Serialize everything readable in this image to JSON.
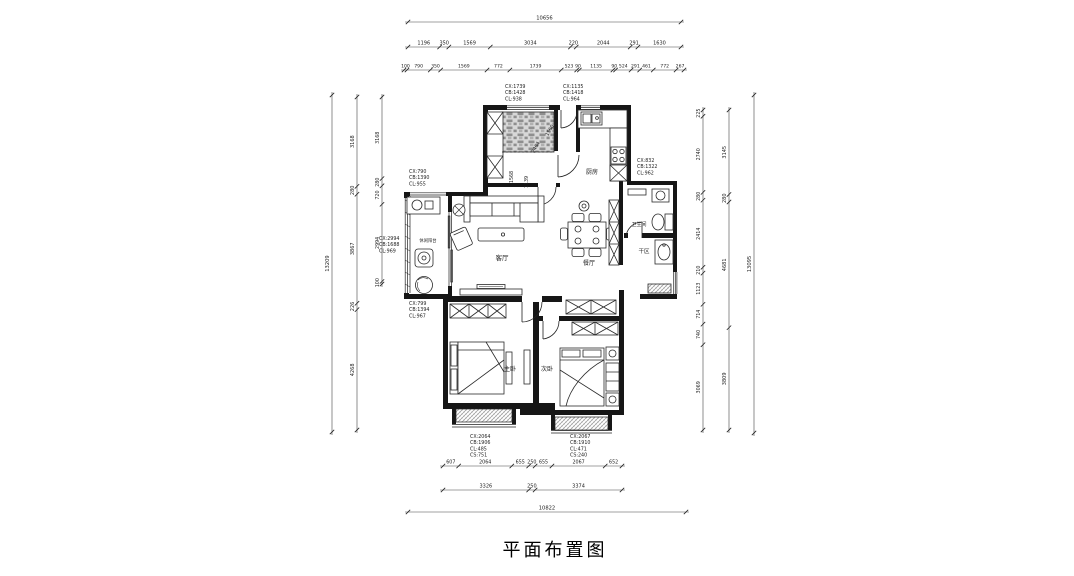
{
  "title": "平面布置图",
  "rooms": {
    "living": "客厅",
    "dining": "餐厅",
    "kitchen": "厨房",
    "bathroom": "卫生间",
    "dry_area": "干区",
    "master_bedroom": "主卧",
    "second_bedroom": "次卧",
    "balcony": "休闲阳台"
  },
  "dimensions": {
    "top": {
      "total": [
        "10656"
      ],
      "row2": [
        "1196",
        "350",
        "1569",
        "3034",
        "220",
        "2044",
        "291",
        "1630"
      ],
      "row3": [
        "100",
        "790",
        "350",
        "1569",
        "772",
        "1739",
        "523",
        "90",
        "1135",
        "90",
        "524",
        "291",
        "461",
        "772",
        "267"
      ]
    },
    "bottom": {
      "row1": [
        "607",
        "2064",
        "655",
        "250",
        "655",
        "2067",
        "652"
      ],
      "row2": [
        "3326",
        "250",
        "3374"
      ],
      "total": [
        "10822"
      ]
    },
    "left": {
      "total": [
        "13209"
      ],
      "mid": [
        "3168",
        "280",
        "3867",
        "226",
        "4268"
      ],
      "inner": [
        "3168",
        "280",
        "720",
        "2994",
        "100"
      ]
    },
    "right": {
      "inner": [
        "225",
        "2740",
        "280",
        "2414",
        "210",
        "1123",
        "714",
        "740",
        "3069"
      ],
      "mid": [
        "3145",
        "280",
        "4681",
        "3809"
      ],
      "total": [
        "13095"
      ]
    },
    "interior": [
      "2464",
      "1560",
      "1568",
      "1139"
    ]
  },
  "window_notes": [
    {
      "id": "top-left-window",
      "lines": [
        "CX:1739",
        "CB:1428",
        "CL:938"
      ]
    },
    {
      "id": "top-right-window",
      "lines": [
        "CX:1135",
        "CB:1418",
        "CL:964"
      ]
    },
    {
      "id": "balcony-top-window",
      "lines": [
        "CX:790",
        "CB:1390",
        "CL:955"
      ]
    },
    {
      "id": "kitchen-right-window",
      "lines": [
        "CX:832",
        "CB:1322",
        "CL:962"
      ]
    },
    {
      "id": "balcony-left-window",
      "lines": [
        "CX:2994",
        "CB:1688",
        "CL:969"
      ]
    },
    {
      "id": "balcony-bottom-window",
      "lines": [
        "CX:799",
        "CB:1394",
        "CL:967"
      ]
    },
    {
      "id": "master-bay-window",
      "lines": [
        "CX:2064",
        "CB:1906",
        "CL:485",
        "CS:751"
      ]
    },
    {
      "id": "second-bay-window",
      "lines": [
        "CX:2067",
        "CB:1910",
        "CL:471",
        "CS:240"
      ]
    }
  ]
}
